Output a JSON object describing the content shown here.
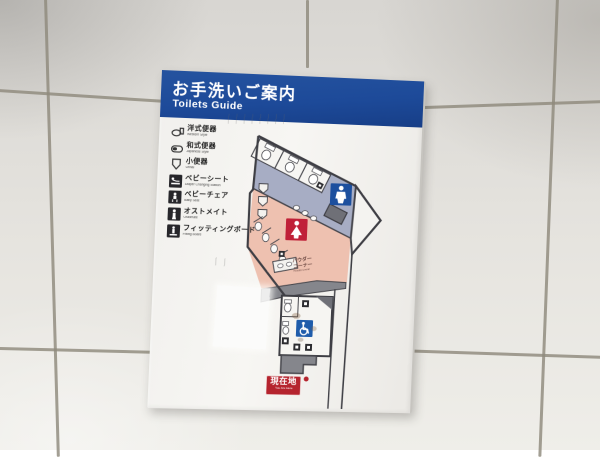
{
  "sign": {
    "header": {
      "title_ja": "お手洗いご案内",
      "title_en": "Toilets Guide",
      "bg_color": "#1d4a99"
    },
    "legend": [
      {
        "ja": "洋式便器",
        "en": "Western Style",
        "icon": "western-toilet-icon"
      },
      {
        "ja": "和式便器",
        "en": "Japanese Style",
        "icon": "japanese-toilet-icon"
      },
      {
        "ja": "小便器",
        "en": "Urinal",
        "icon": "urinal-icon"
      },
      {
        "ja": "ベビーシート",
        "en": "Diaper Changing Station",
        "icon": "diaper-changing-station-icon"
      },
      {
        "ja": "ベビーチェア",
        "en": "Baby Seat",
        "icon": "baby-chair-icon"
      },
      {
        "ja": "オストメイト",
        "en": "Ostomate",
        "icon": "ostomate-icon"
      },
      {
        "ja": "フィッティングボード",
        "en": "Fitting Board",
        "icon": "fitting-board-icon"
      }
    ],
    "map": {
      "mens_icon": "mens-toilet-icon",
      "womens_icon": "womens-toilet-icon",
      "accessible_icon": "wheelchair-icon",
      "powder_corner": {
        "line1": "パウダー",
        "line2": "コーナー",
        "en": "Powder Corner"
      },
      "marker": {
        "ja": "現在地",
        "en": "You Are Here"
      },
      "colors": {
        "mens_area": "#a7adc4",
        "womens_area": "#eec1b0",
        "corridor": "#85868c",
        "mens_sign_blue": "#1c4f9e",
        "womens_sign_red": "#c02038",
        "accessible_sign_blue": "#1f5cab",
        "marker_red": "#b5242e",
        "outline": "#46464c"
      }
    }
  }
}
